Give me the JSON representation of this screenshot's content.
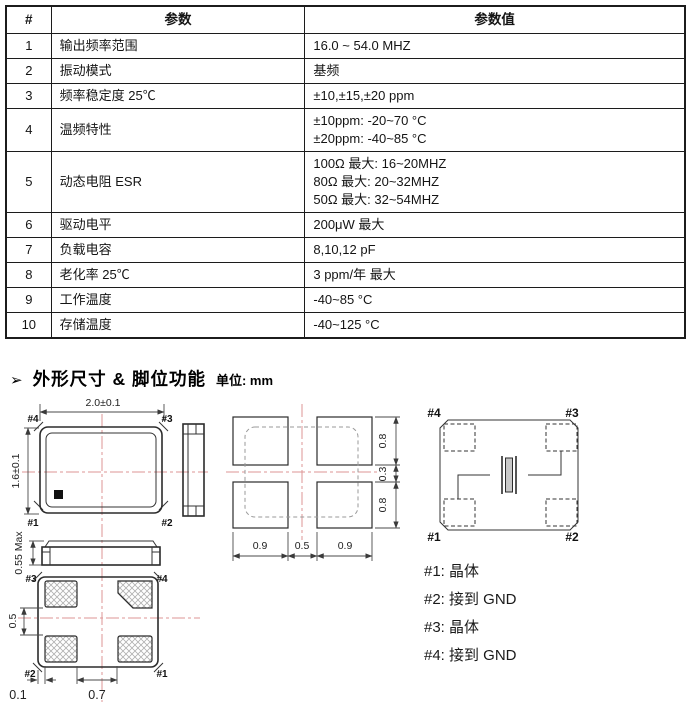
{
  "table": {
    "headers": {
      "num": "#",
      "param": "参数",
      "value": "参数值"
    },
    "rows": [
      {
        "num": "1",
        "param": "输出频率范围",
        "value": "16.0 ~ 54.0 MHZ"
      },
      {
        "num": "2",
        "param": "振动模式",
        "value": "基频"
      },
      {
        "num": "3",
        "param": "频率稳定度 25℃",
        "value": "±10,±15,±20 ppm"
      },
      {
        "num": "4",
        "param": "温频特性",
        "value": "±10ppm:  -20~70 °C\n±20ppm:  -40~85 °C"
      },
      {
        "num": "5",
        "param": "动态电阻 ESR",
        "value": "100Ω 最大: 16~20MHZ\n80Ω  最大: 20~32MHZ\n50Ω  最大: 32~54MHZ"
      },
      {
        "num": "6",
        "param": "驱动电平",
        "value": "200μW 最大"
      },
      {
        "num": "7",
        "param": "负载电容",
        "value": "8,10,12 pF"
      },
      {
        "num": "8",
        "param": "老化率 25℃",
        "value": "3 ppm/年 最大"
      },
      {
        "num": "9",
        "param": "工作温度",
        "value": "-40~85 °C"
      },
      {
        "num": "10",
        "param": "存储温度",
        "value": "-40~125 °C"
      }
    ]
  },
  "section": {
    "bullet": "➢",
    "title": "外形尺寸 & 脚位功能",
    "unit_label": "单位: mm"
  },
  "drawing": {
    "top_view": {
      "width_dim": "2.0±0.1",
      "height_dim": "1.6±0.1",
      "pin_tl": "#4",
      "pin_tr": "#3",
      "pin_bl": "#1",
      "pin_br": "#2"
    },
    "front_view": {
      "height_dim": "0.55 Max"
    },
    "bottom_view": {
      "pin_tl": "#3",
      "pin_tr": "#4",
      "pin_bl": "#2",
      "pin_br": "#1",
      "gap_dim": "0.5",
      "edge_dim": "0.1",
      "pitch_dim": "0.7"
    },
    "land_pattern": {
      "pad_w_left": "0.9",
      "pad_gap_x": "0.5",
      "pad_w_right": "0.9",
      "pad_h_top": "0.8",
      "pad_gap_y": "0.3",
      "pad_h_bottom": "0.8"
    },
    "schematic": {
      "pin_tl": "#4",
      "pin_tr": "#3",
      "pin_bl": "#1",
      "pin_br": "#2"
    },
    "pin_functions": [
      "#1: 晶体",
      "#2: 接到 GND",
      "#3: 晶体",
      "#4: 接到 GND"
    ]
  },
  "colors": {
    "border": "#1c1c1c",
    "line": "#333333",
    "centerline": "#dd9494",
    "hatch": "#b0b0b0",
    "crystal_fill": "#c8c8c8"
  }
}
